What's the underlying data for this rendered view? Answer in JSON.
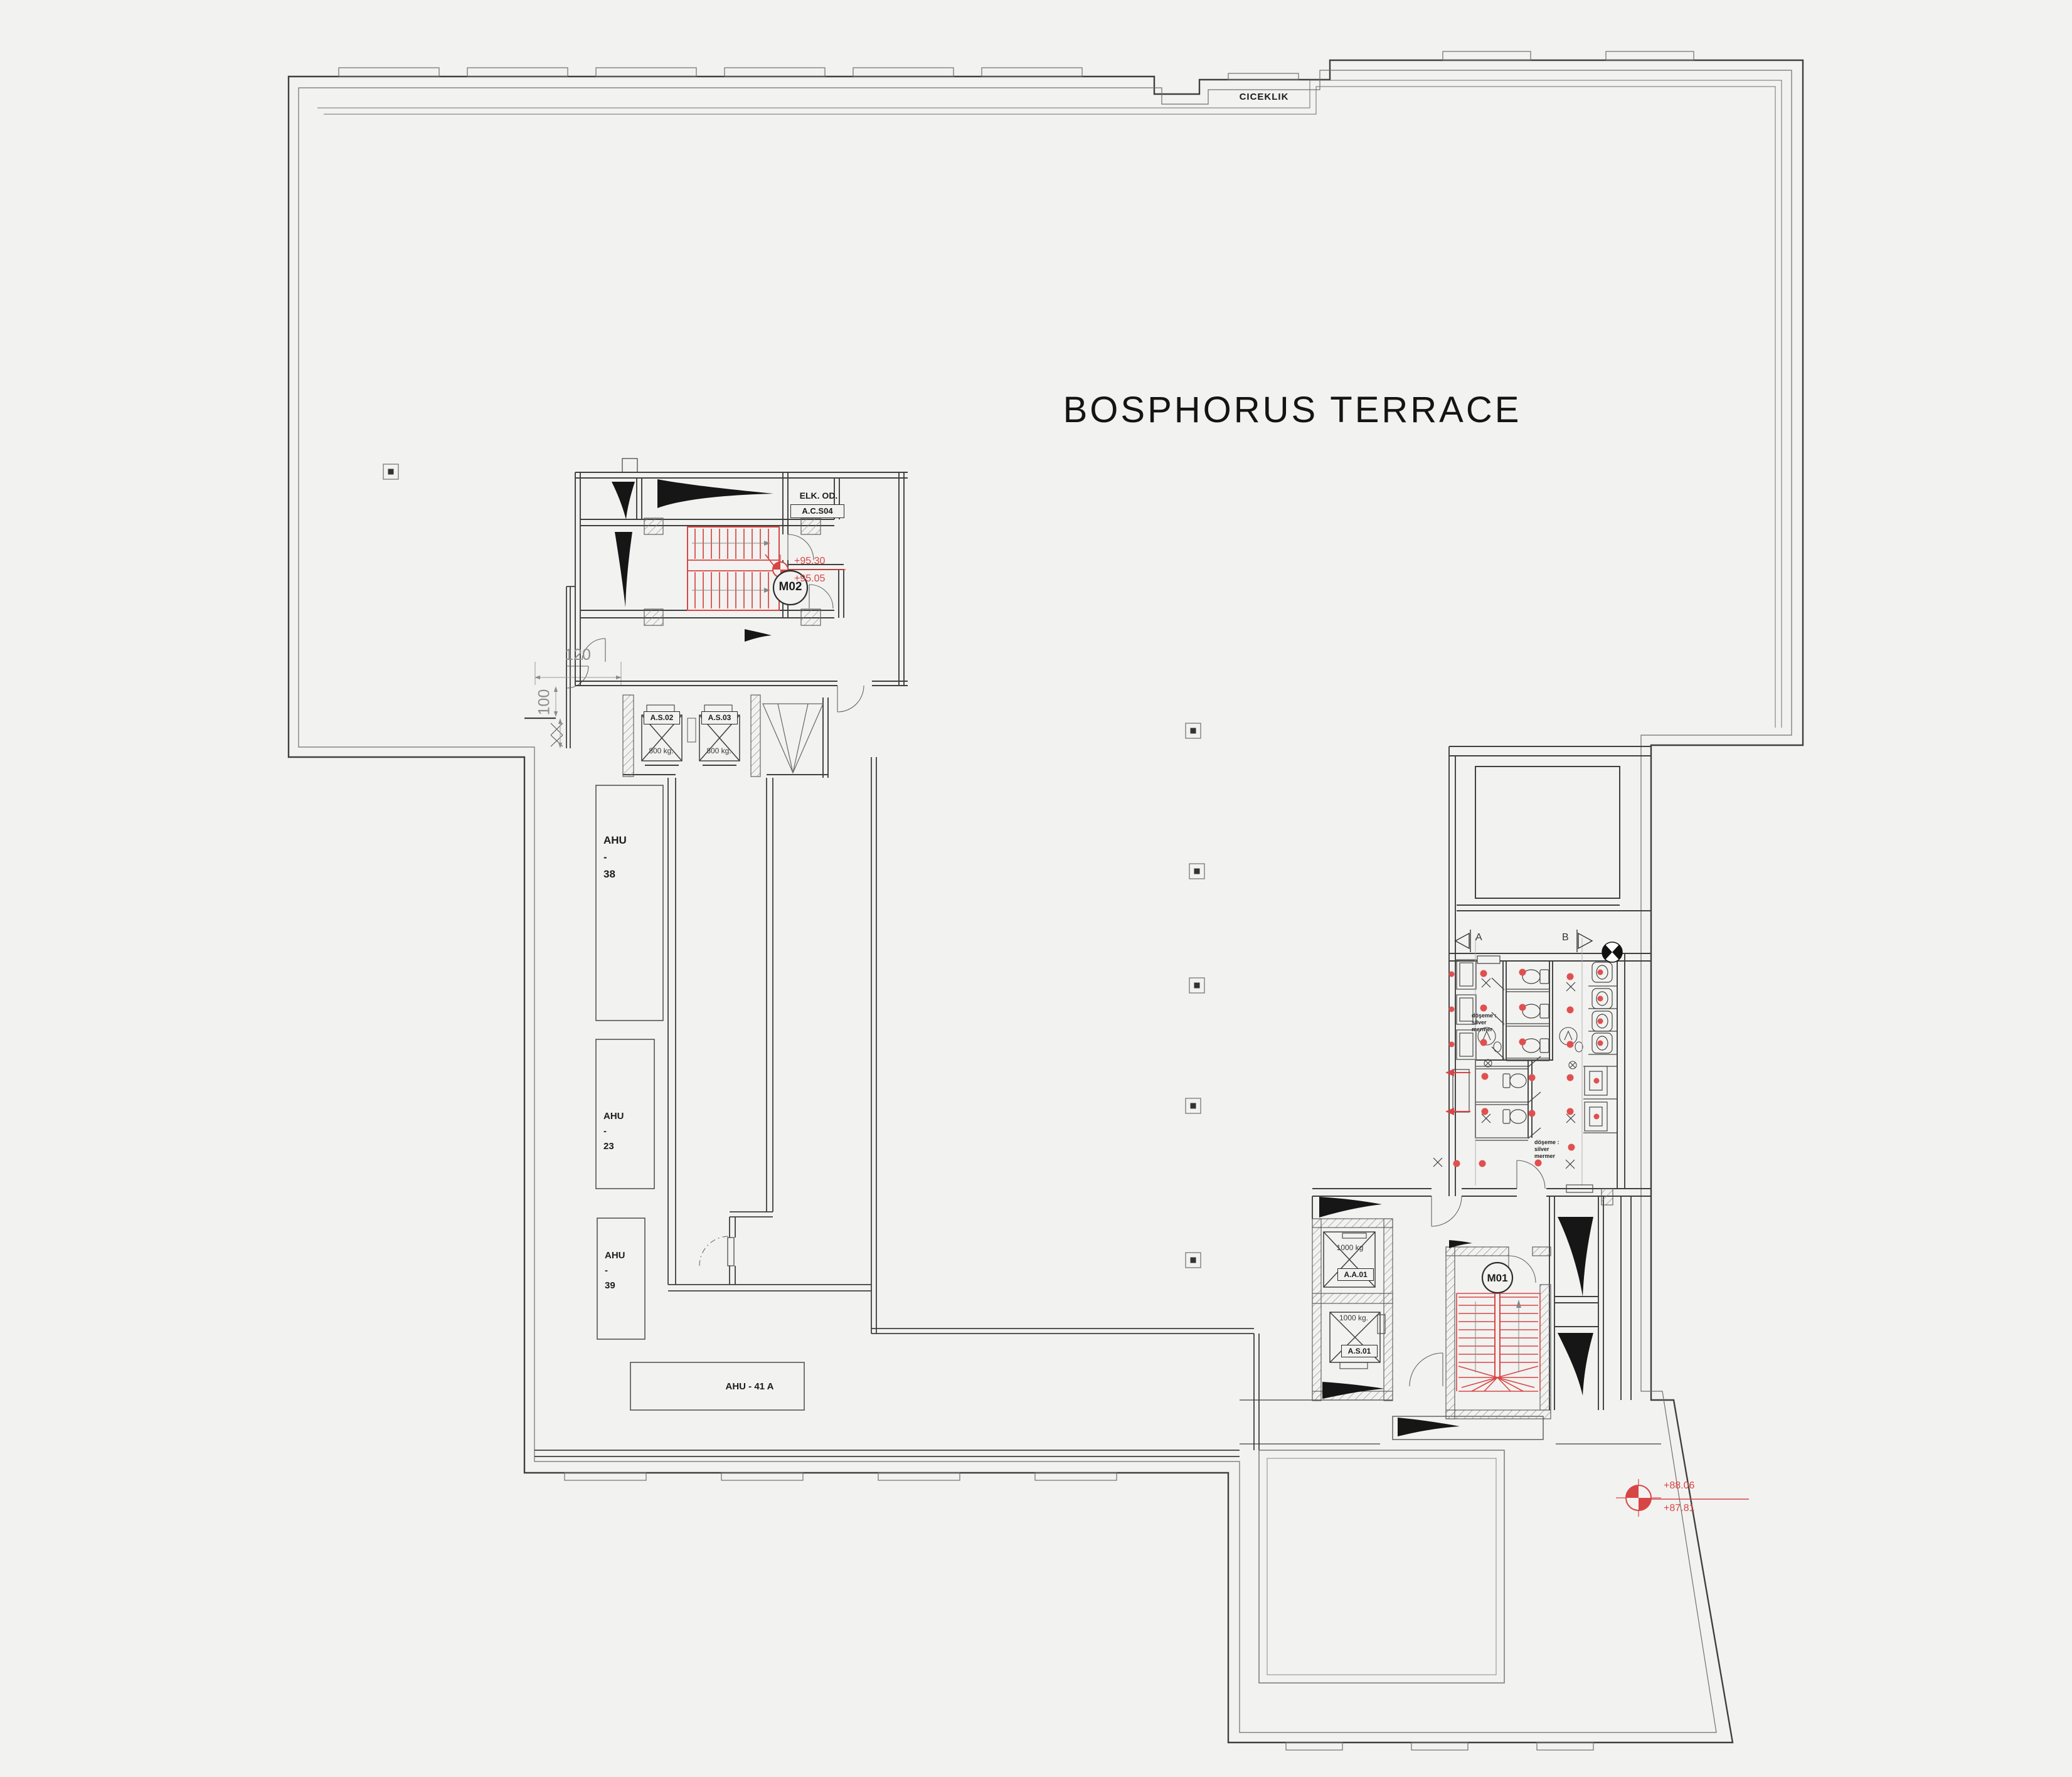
{
  "plan": {
    "title": "BOSPHORUS TERRACE",
    "planter_label": "CICEKLIK",
    "rooms": {
      "elk_name": "ELK. OD.",
      "elk_code": "A.C.S04",
      "stair_m02": "M02",
      "stair_m01": "M01"
    },
    "elevators": {
      "as02_id": "A.S.02",
      "as02_cap": "800 kg.",
      "as03_id": "A.S.03",
      "as03_cap": "800 kg.",
      "aa01_id": "A.A.01",
      "aa01_cap": "1000 kg",
      "as01_id": "A.S.01",
      "as01_cap": "1000 kg."
    },
    "ahu": {
      "a38_1": "AHU",
      "a38_2": "-",
      "a38_3": "38",
      "a23_1": "AHU",
      "a23_2": "-",
      "a23_3": "23",
      "a39_1": "AHU",
      "a39_2": "-",
      "a39_3": "39",
      "a41": "AHU - 41 A"
    },
    "dims": {
      "w120": "120",
      "w100": "100"
    },
    "levels": {
      "m02_upper": "+95.30",
      "m02_lower": "+95.05",
      "terrace_upper": "+88.06",
      "terrace_lower": "+87.81"
    },
    "sections": {
      "a": "A",
      "b": "B"
    },
    "note": {
      "l1": "döşeme :",
      "l2": "silver",
      "l3": "mermer"
    },
    "colors": {
      "accent_red": "#d84545",
      "line": "#3f3f3f",
      "background": "#f2f2f0"
    },
    "symbols": [
      "stair-run-icon",
      "elevator-cross-icon",
      "wc-toilet-icon",
      "wc-sink-icon",
      "wc-urinal-icon",
      "column-marker-icon",
      "level-benchmark-icon",
      "section-arrow-icon",
      "duct-wedge-icon",
      "wall-hatch-icon",
      "door-swing-icon"
    ]
  }
}
